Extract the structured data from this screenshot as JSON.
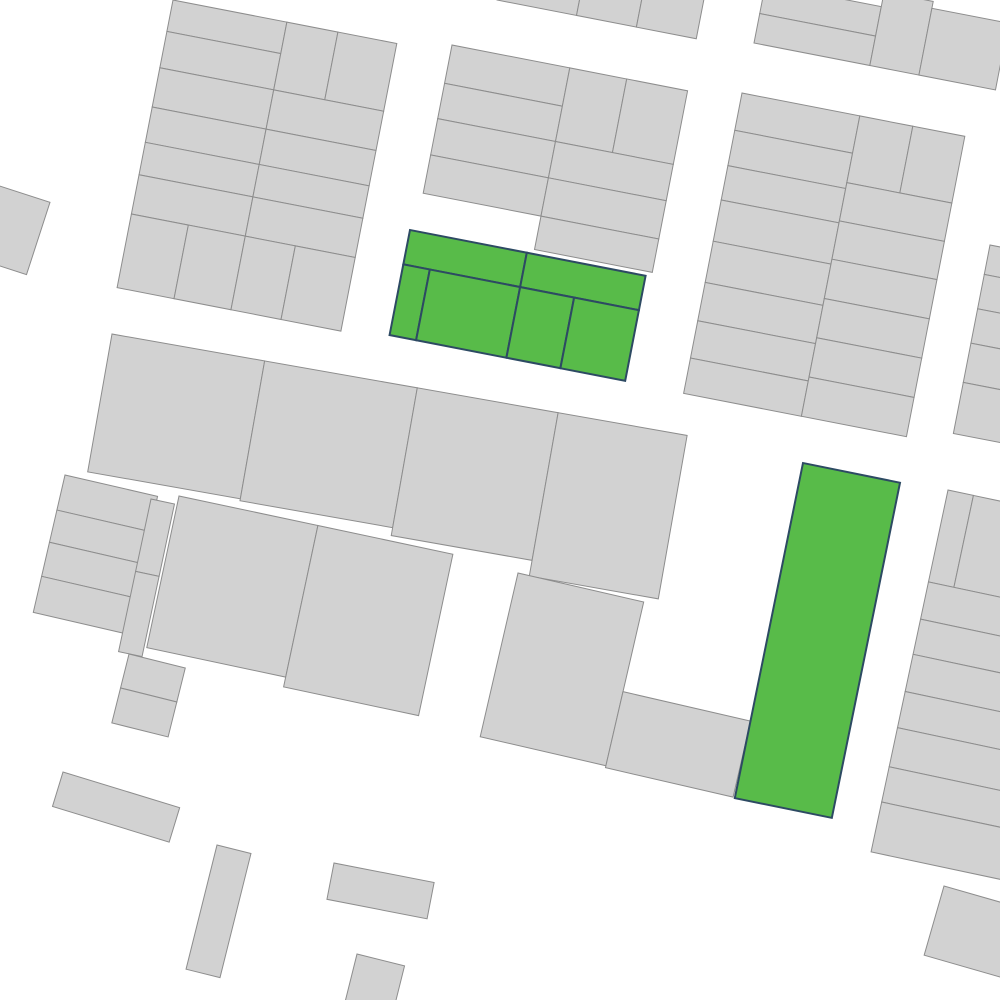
{
  "canvas": {
    "width": 1000,
    "height": 1000,
    "background": "#ffffff"
  },
  "styles": {
    "parcel_fill": "#d2d2d2",
    "parcel_stroke": "#8d8d8d",
    "parcel_stroke_width": 1,
    "highlight_fill": "#58bb49",
    "highlight_stroke": "#2d4a63",
    "highlight_stroke_width": 2
  },
  "map": {
    "blocks": [
      {
        "name": "block-top-center-cut",
        "anchor": [
          497,
          0
        ],
        "rotation": 11,
        "highlight": false,
        "parcels": [
          [
            0,
            -70,
            81,
            70
          ],
          [
            81,
            -70,
            61,
            70
          ],
          [
            142,
            -70,
            61,
            70
          ]
        ]
      },
      {
        "name": "block-top-left",
        "anchor": [
          173,
          0
        ],
        "rotation": 11,
        "highlight": false,
        "parcels": [
          [
            0,
            0,
            116,
            32
          ],
          [
            0,
            32,
            116,
            37
          ],
          [
            0,
            69,
            116,
            40
          ],
          [
            0,
            109,
            116,
            36
          ],
          [
            0,
            145,
            116,
            33
          ],
          [
            0,
            178,
            116,
            40
          ],
          [
            0,
            218,
            58,
            75
          ],
          [
            58,
            218,
            58,
            75
          ],
          [
            116,
            0,
            52,
            69
          ],
          [
            168,
            0,
            60,
            69
          ],
          [
            116,
            69,
            112,
            40
          ],
          [
            116,
            109,
            112,
            36
          ],
          [
            116,
            145,
            112,
            33
          ],
          [
            116,
            178,
            112,
            40
          ],
          [
            116,
            218,
            51,
            75
          ],
          [
            167,
            218,
            61,
            75
          ]
        ]
      },
      {
        "name": "block-far-left",
        "anchor": [
          -28,
          177
        ],
        "rotation": 18,
        "highlight": false,
        "parcels": [
          [
            0,
            0,
            82,
            76
          ]
        ]
      },
      {
        "name": "block-top-middle",
        "anchor": [
          452,
          45
        ],
        "rotation": 11,
        "highlight": false,
        "parcels": [
          [
            0,
            0,
            120,
            39
          ],
          [
            0,
            39,
            120,
            36
          ],
          [
            0,
            75,
            120,
            37
          ],
          [
            0,
            112,
            120,
            39
          ],
          [
            120,
            0,
            58,
            75
          ],
          [
            178,
            0,
            62,
            75
          ],
          [
            120,
            75,
            120,
            37
          ],
          [
            120,
            112,
            120,
            39
          ],
          [
            120,
            151,
            120,
            34
          ]
        ]
      },
      {
        "name": "block-top-right-upper",
        "anchor": [
          754,
          43
        ],
        "rotation": 11,
        "highlight": false,
        "parcels": [
          [
            0,
            -60,
            118,
            30
          ],
          [
            0,
            -30,
            118,
            30
          ],
          [
            118,
            -75,
            50,
            75
          ],
          [
            168,
            -68,
            78,
            68
          ]
        ]
      },
      {
        "name": "block-top-right-main",
        "anchor": [
          742,
          93
        ],
        "rotation": 11,
        "highlight": false,
        "parcels": [
          [
            0,
            0,
            120,
            38
          ],
          [
            0,
            38,
            120,
            36
          ],
          [
            0,
            74,
            120,
            35
          ],
          [
            0,
            109,
            120,
            42
          ],
          [
            0,
            151,
            120,
            42
          ],
          [
            0,
            193,
            120,
            39
          ],
          [
            0,
            232,
            120,
            38
          ],
          [
            0,
            270,
            120,
            36
          ],
          [
            120,
            0,
            54,
            68
          ],
          [
            174,
            0,
            53,
            68
          ],
          [
            120,
            68,
            107,
            39
          ],
          [
            120,
            107,
            107,
            39
          ],
          [
            120,
            146,
            107,
            40
          ],
          [
            120,
            186,
            107,
            40
          ],
          [
            120,
            226,
            107,
            40
          ],
          [
            120,
            266,
            107,
            40
          ]
        ]
      },
      {
        "name": "block-middle-band",
        "anchor": [
          112,
          334
        ],
        "rotation": 10,
        "highlight": false,
        "parcels": [
          [
            0,
            0,
            155,
            140
          ],
          [
            155,
            0,
            155,
            142
          ],
          [
            310,
            0,
            143,
            150
          ],
          [
            453,
            0,
            131,
            166
          ]
        ]
      },
      {
        "name": "block-left-small",
        "anchor": [
          65,
          475
        ],
        "rotation": 13,
        "highlight": false,
        "parcels": [
          [
            0,
            0,
            95,
            36
          ],
          [
            0,
            36,
            95,
            33
          ],
          [
            0,
            69,
            95,
            35
          ],
          [
            0,
            104,
            95,
            37
          ]
        ]
      },
      {
        "name": "block-narrow-strip",
        "anchor": [
          151,
          499
        ],
        "rotation": 12,
        "highlight": false,
        "parcels": [
          [
            0,
            0,
            24,
            74
          ],
          [
            0,
            74,
            24,
            82
          ]
        ]
      },
      {
        "name": "block-small-pair",
        "anchor": [
          129,
          654
        ],
        "rotation": 14,
        "highlight": false,
        "parcels": [
          [
            0,
            0,
            58,
            35
          ],
          [
            0,
            35,
            58,
            36
          ]
        ]
      },
      {
        "name": "block-lower-left-big",
        "anchor": [
          179,
          496
        ],
        "rotation": 12,
        "highlight": false,
        "parcels": [
          [
            0,
            0,
            142,
            155
          ],
          [
            142,
            0,
            138,
            165
          ]
        ]
      },
      {
        "name": "block-bottom-center",
        "anchor": [
          518,
          573
        ],
        "rotation": 13,
        "highlight": false,
        "parcels": [
          [
            0,
            0,
            129,
            168
          ],
          [
            129,
            92,
            131,
            78
          ]
        ]
      },
      {
        "name": "block-right-upper-sliver",
        "anchor": [
          990,
          245
        ],
        "rotation": 11,
        "highlight": false,
        "parcels": [
          [
            0,
            0,
            70,
            30
          ],
          [
            0,
            30,
            70,
            35
          ],
          [
            0,
            65,
            70,
            35
          ],
          [
            0,
            100,
            70,
            40
          ],
          [
            0,
            140,
            70,
            52
          ]
        ]
      },
      {
        "name": "block-right-main",
        "anchor": [
          948,
          490
        ],
        "rotation": 12,
        "highlight": false,
        "parcels": [
          [
            0,
            0,
            26,
            94
          ],
          [
            26,
            0,
            134,
            94
          ],
          [
            0,
            94,
            160,
            38
          ],
          [
            0,
            132,
            160,
            36
          ],
          [
            0,
            168,
            160,
            38
          ],
          [
            0,
            206,
            160,
            37
          ],
          [
            0,
            243,
            160,
            40
          ],
          [
            0,
            283,
            160,
            36
          ],
          [
            0,
            319,
            160,
            51
          ]
        ]
      },
      {
        "name": "block-bottom-right-corner",
        "anchor": [
          944,
          886
        ],
        "rotation": 16,
        "highlight": false,
        "parcels": [
          [
            0,
            0,
            85,
            72
          ]
        ]
      },
      {
        "name": "detached-bar-1",
        "anchor": [
          63,
          772
        ],
        "rotation": 17,
        "highlight": false,
        "parcels": [
          [
            0,
            0,
            122,
            36
          ]
        ]
      },
      {
        "name": "detached-bar-2",
        "anchor": [
          217,
          845
        ],
        "rotation": 14,
        "highlight": false,
        "parcels": [
          [
            0,
            0,
            35,
            128
          ]
        ]
      },
      {
        "name": "detached-bar-3",
        "anchor": [
          334,
          863
        ],
        "rotation": 11,
        "highlight": false,
        "parcels": [
          [
            0,
            0,
            102,
            37
          ]
        ]
      },
      {
        "name": "detached-bar-4",
        "anchor": [
          357,
          954
        ],
        "rotation": 14,
        "highlight": false,
        "parcels": [
          [
            0,
            0,
            49,
            60
          ]
        ]
      },
      {
        "name": "highlighted-cluster",
        "anchor": [
          410,
          230
        ],
        "rotation": 11,
        "highlight": true,
        "parcels": [
          [
            0,
            0,
            119,
            35
          ],
          [
            119,
            0,
            121,
            35
          ],
          [
            0,
            35,
            27,
            72
          ],
          [
            27,
            35,
            92,
            72
          ],
          [
            119,
            35,
            55,
            72
          ],
          [
            174,
            35,
            66,
            72
          ]
        ]
      },
      {
        "name": "highlighted-bar",
        "anchor": [
          803,
          463
        ],
        "rotation": 11.5,
        "highlight": true,
        "parcels": [
          [
            0,
            0,
            99,
            342
          ]
        ]
      }
    ]
  }
}
